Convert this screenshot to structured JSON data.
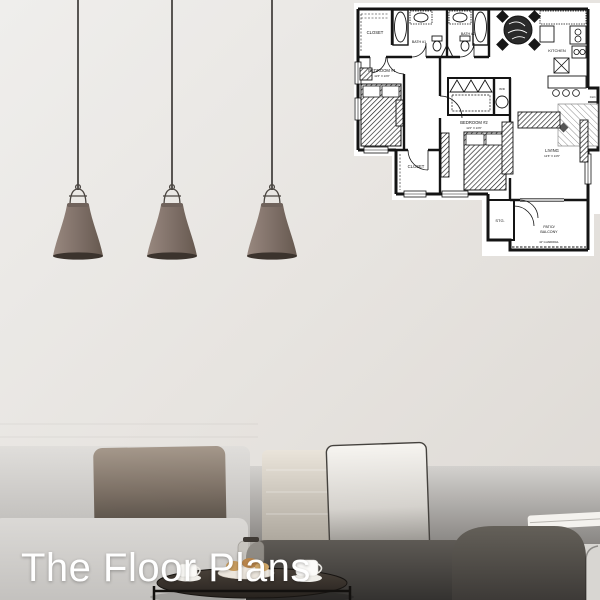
{
  "hero": {
    "title": "The Floor Plans"
  },
  "floor_plan": {
    "rooms": {
      "closet1": "CLOSET",
      "bath1": "BATH #1",
      "bath2": "BATH #2",
      "bedroom1": "BEDROOM #1",
      "bedroom1_dims": "11'6\" X 13'0\"",
      "bedroom2": "BEDROOM #2",
      "bedroom2_dims": "11'0\" X 13'6\"",
      "closet2": "CLOSET",
      "kitchen": "KITCHEN",
      "living": "LIVING",
      "living_dims": "12'6\" X 13'6\"",
      "clo": "CLO.",
      "stg": "STG.",
      "patio_line1": "PATIO/",
      "patio_line2": "BALCONY",
      "guardrail": "42\" GUARDRAIL",
      "washer": "W/D"
    }
  },
  "scene": {
    "colors": {
      "wall": "#e9e6e2",
      "lamp_shade": "#83756d",
      "sofa_light": "#d8d6d3",
      "sofa_dark": "#4e4a45",
      "pillow_taupe": "#8d7f72",
      "pillow_white": "#f3f1ed",
      "plan_paper": "#ffffff",
      "plan_ink": "#141414",
      "title": "#ffffff"
    }
  }
}
